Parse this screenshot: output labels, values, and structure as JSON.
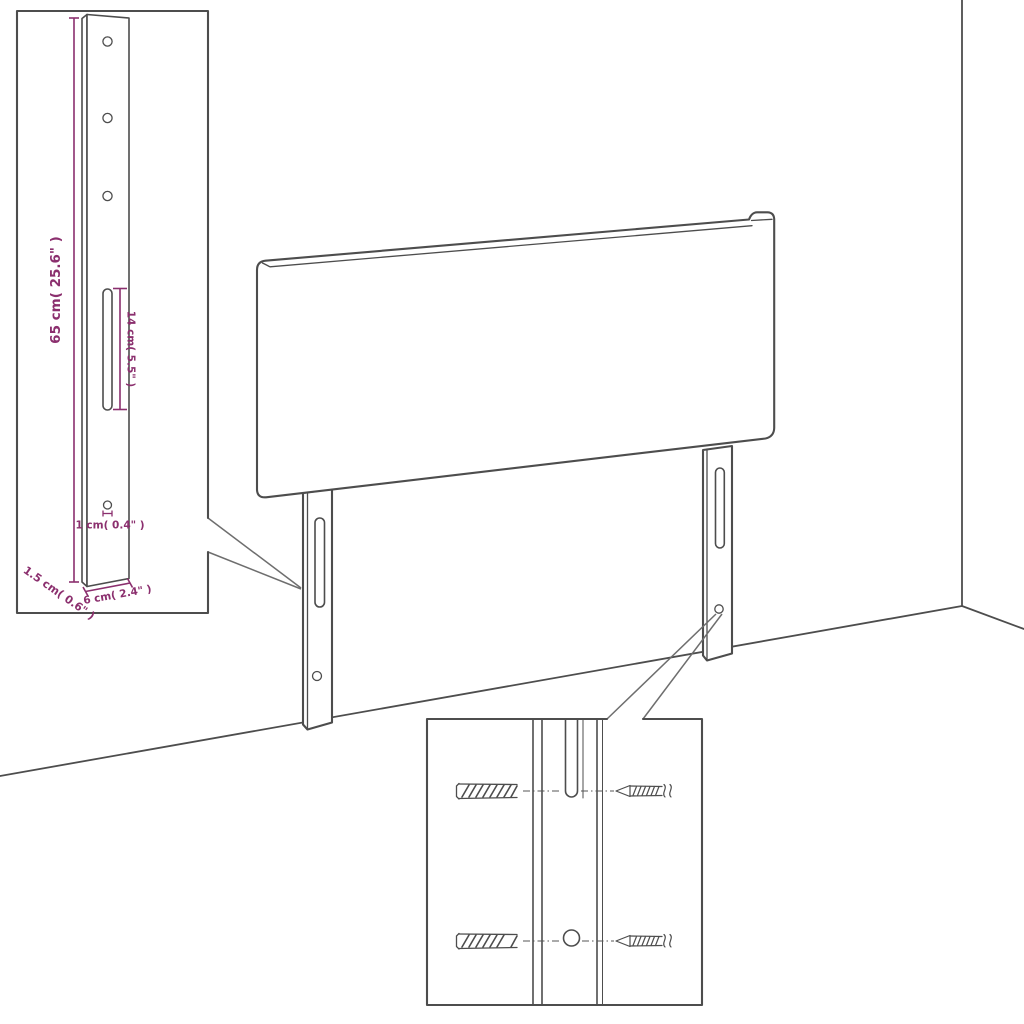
{
  "diagram": {
    "background": "#ffffff",
    "line_color": "#4d4d4d",
    "accent_color": "#8b2f6e",
    "labels": {
      "bracket_height": "65 cm( 25.6\" )",
      "slot_length": "14 cm( 5.5\" )",
      "hole_diameter": "1 cm( 0.4\" )",
      "bracket_thickness": "1.5 cm( 0.6\" )",
      "bracket_width": "6 cm( 2.4\" )"
    }
  }
}
